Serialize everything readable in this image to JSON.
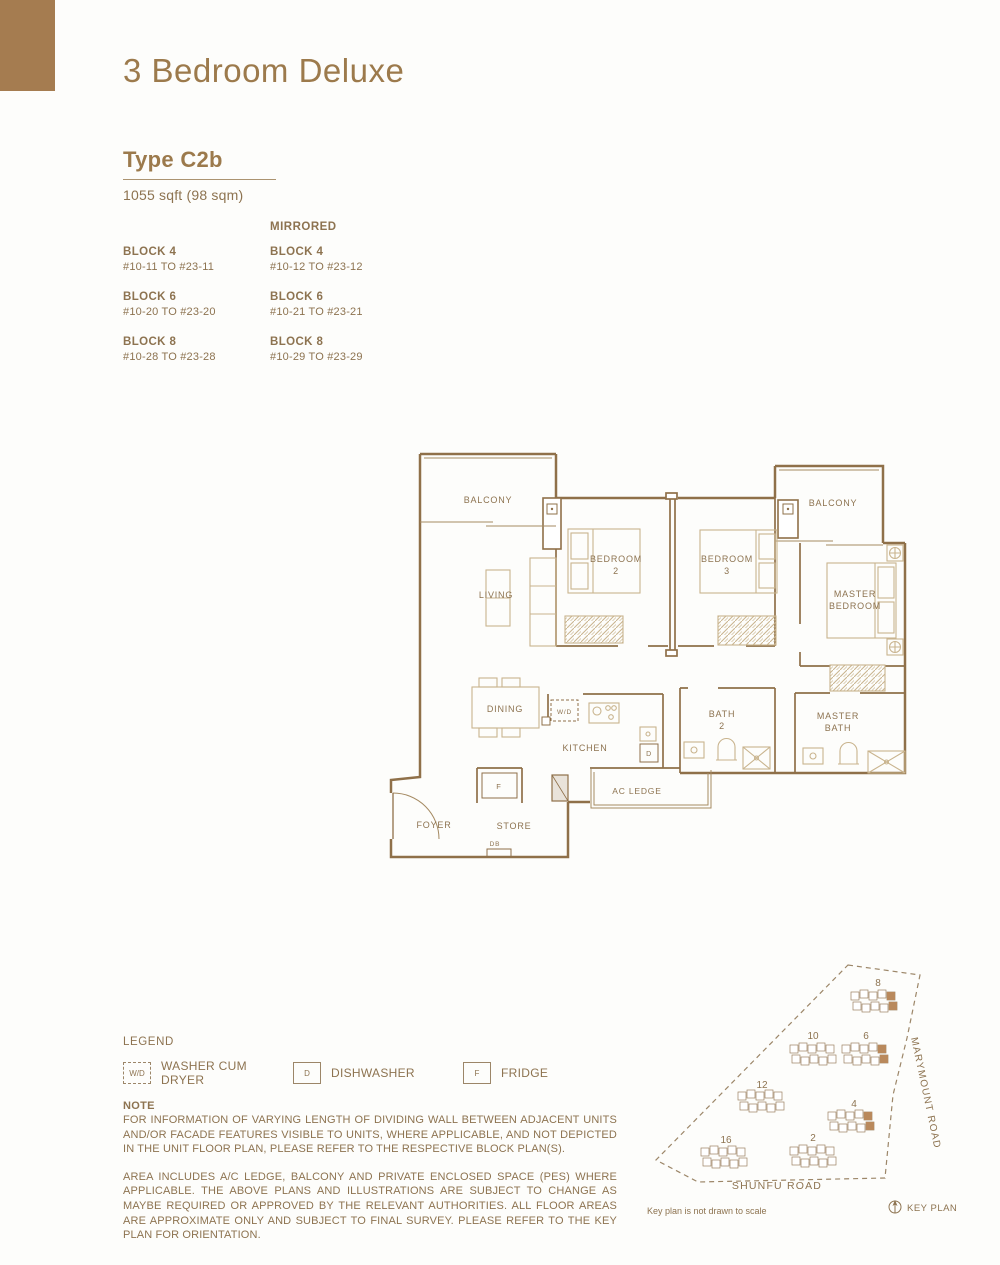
{
  "header": {
    "title": "3 Bedroom Deluxe"
  },
  "unit": {
    "type_label": "Type C2b",
    "area": "1055 sqft (98 sqm)"
  },
  "availability": {
    "mirrored_heading": "MIRRORED",
    "standard": [
      {
        "block": "BLOCK 4",
        "units": "#10-11 TO #23-11"
      },
      {
        "block": "BLOCK 6",
        "units": "#10-20 TO #23-20"
      },
      {
        "block": "BLOCK 8",
        "units": "#10-28 TO #23-28"
      }
    ],
    "mirrored": [
      {
        "block": "BLOCK 4",
        "units": "#10-12 TO #23-12"
      },
      {
        "block": "BLOCK 6",
        "units": "#10-21 TO #23-21"
      },
      {
        "block": "BLOCK 8",
        "units": "#10-29 TO #23-29"
      }
    ]
  },
  "floor_plan": {
    "labels": {
      "balcony_left": "BALCONY",
      "balcony_right": "BALCONY",
      "living": "LIVING",
      "bedroom2_line1": "BEDROOM",
      "bedroom2_line2": "2",
      "bedroom3_line1": "BEDROOM",
      "bedroom3_line2": "3",
      "master_line1": "MASTER",
      "master_line2": "BEDROOM",
      "dining": "DINING",
      "kitchen": "KITCHEN",
      "bath2_line1": "BATH",
      "bath2_line2": "2",
      "master_bath_line1": "MASTER",
      "master_bath_line2": "BATH",
      "ac_ledge": "AC LEDGE",
      "foyer": "FOYER",
      "store": "STORE",
      "db": "DB",
      "wd": "W/D",
      "dishwasher": "D",
      "fridge": "F"
    }
  },
  "legend": {
    "heading": "LEGEND",
    "items": [
      {
        "symbol": "W/D",
        "label": "WASHER CUM DRYER"
      },
      {
        "symbol": "D",
        "label": "DISHWASHER"
      },
      {
        "symbol": "F",
        "label": "FRIDGE"
      }
    ]
  },
  "note": {
    "heading": "NOTE",
    "paragraph1": "FOR INFORMATION OF VARYING LENGTH OF DIVIDING WALL BETWEEN ADJACENT UNITS AND/OR FACADE FEATURES VISIBLE TO UNITS, WHERE APPLICABLE, AND NOT DEPICTED IN THE UNIT FLOOR PLAN, PLEASE REFER TO THE RESPECTIVE BLOCK PLAN(S).",
    "paragraph2": "AREA INCLUDES A/C LEDGE, BALCONY AND PRIVATE ENCLOSED SPACE (PES) WHERE APPLICABLE. THE ABOVE PLANS AND ILLUSTRATIONS ARE SUBJECT TO CHANGE AS MAYBE REQUIRED OR APPROVED BY THE RELEVANT AUTHORITIES. ALL FLOOR AREAS ARE APPROXIMATE ONLY AND SUBJECT TO FINAL SURVEY. PLEASE REFER TO THE KEY PLAN FOR ORIENTATION.",
    "highlighted_blocks": [
      "4",
      "6",
      "8"
    ]
  },
  "key_plan": {
    "block_labels": {
      "b2": "2",
      "b4": "4",
      "b6": "6",
      "b8": "8",
      "b10": "10",
      "b12": "12",
      "b16": "16"
    },
    "roads": {
      "marymount": "MARYMOUNT ROAD",
      "shunfu": "SHUNFU ROAD"
    },
    "disclaimer": "Key plan is not drawn to scale",
    "caption": "KEY PLAN"
  },
  "colors": {
    "brand_brown": "#a57c50",
    "heading_brown": "#9c7a4c",
    "body_brown": "#8d7350",
    "wall_brown": "#8f7049",
    "furniture_tan": "#c9b48e",
    "highlight_brown": "#b9895c"
  }
}
